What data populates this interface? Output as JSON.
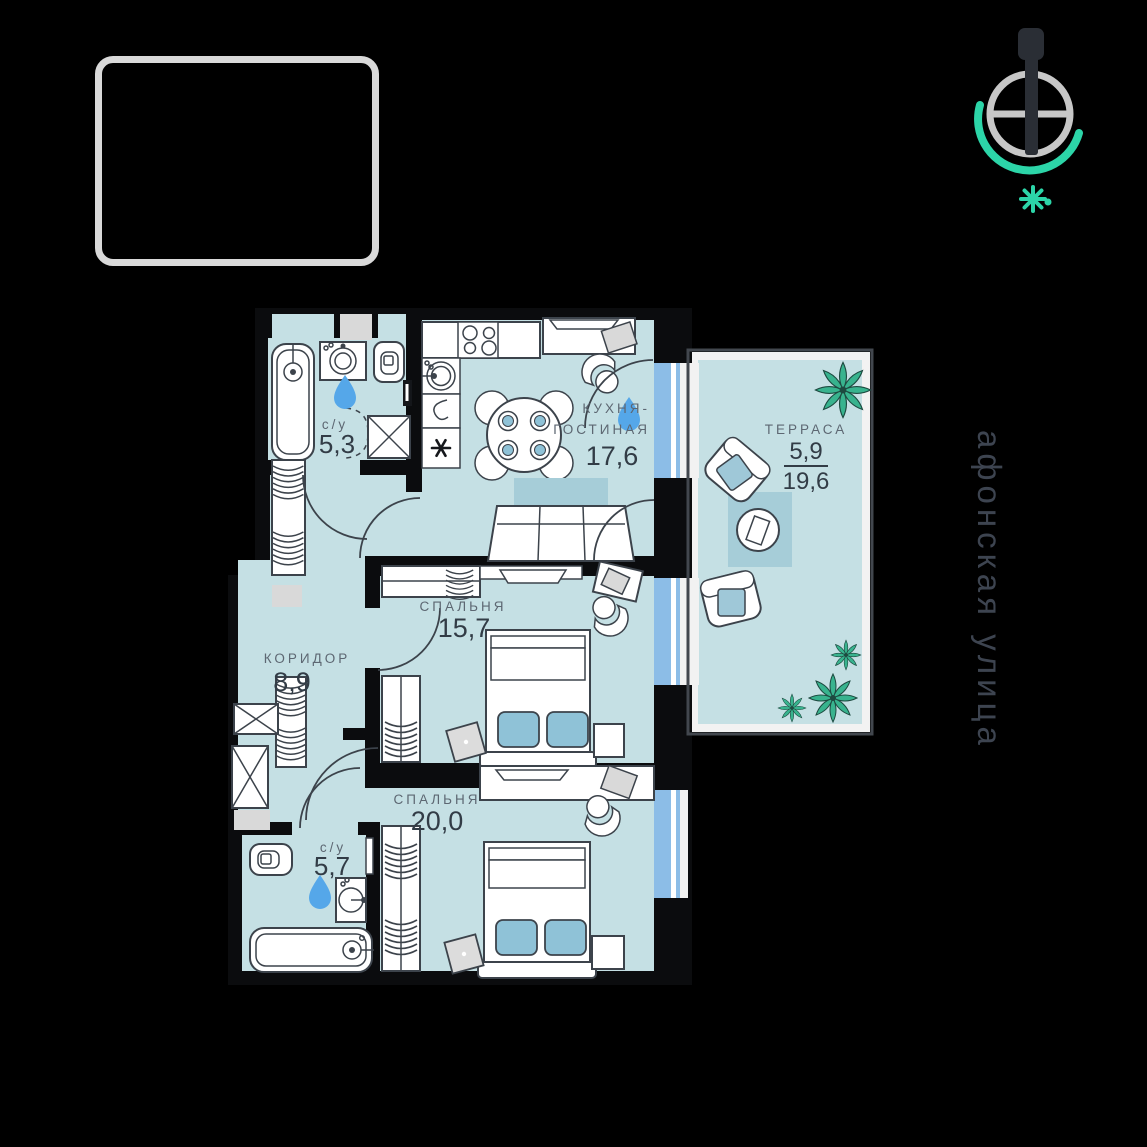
{
  "colors": {
    "background": "#000000",
    "wall": "#0b0c0e",
    "room_fill": "#c5e0e4",
    "rug_fill": "#a6cdd8",
    "pillow_fill": "#8fc2d7",
    "window_glass": "#8cbde7",
    "water_drop": "#55a7e9",
    "plant_green": "#38b38e",
    "compass_accent": "#2cd5a8",
    "frame_gray": "#d9d9d9",
    "label_gray": "#5d6772",
    "number_dark": "#323c46"
  },
  "icons": {
    "compass": "compass-north-needle",
    "sun": "sun-position",
    "logo": "logo-placeholder-frame"
  },
  "street_label": "афонская улица",
  "rooms": {
    "bathroom1": {
      "label": "с/у",
      "area": "5,3"
    },
    "kitchen_living": {
      "label_line1": "КУХНЯ-",
      "label_line2": "ГОСТИНАЯ",
      "area": "17,6"
    },
    "terrace": {
      "label": "ТЕРРАСА",
      "area_counted": "5,9",
      "area_total": "19,6"
    },
    "bedroom1": {
      "label": "СПАЛЬНЯ",
      "area": "15,7"
    },
    "corridor": {
      "label": "КОРИДОР",
      "area": "8,9"
    },
    "bedroom2": {
      "label": "СПАЛЬНЯ",
      "area": "20,0"
    },
    "bathroom2": {
      "label": "с/у",
      "area": "5,7"
    }
  }
}
